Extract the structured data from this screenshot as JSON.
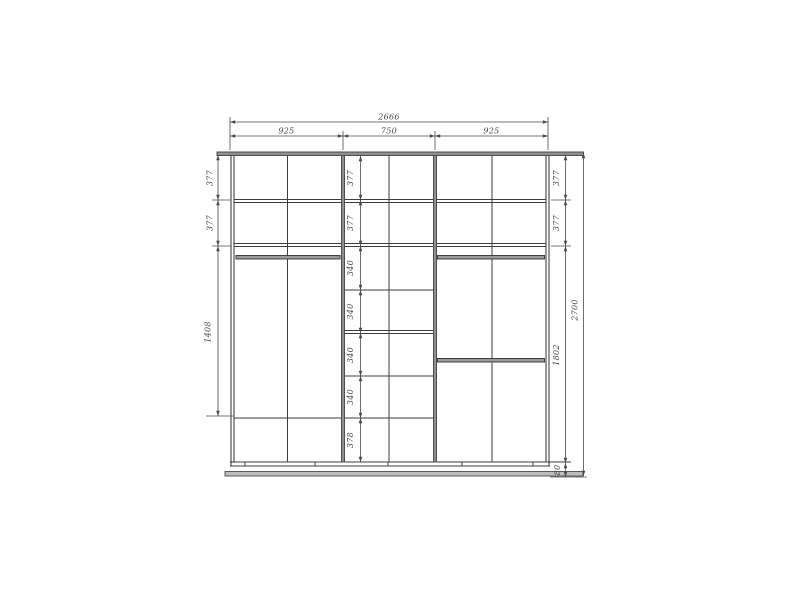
{
  "dims": {
    "total_width": "2666",
    "top_sections": [
      "925",
      "750",
      "925"
    ],
    "left_chain": [
      "377",
      "377",
      "1408"
    ],
    "middle_chain": [
      "377",
      "377",
      "340",
      "340",
      "340",
      "340",
      "378"
    ],
    "right_chain": [
      "377",
      "377",
      "1802",
      "80"
    ],
    "total_height": "2700"
  },
  "colors": {
    "background": "#ffffff",
    "structure_line": "#3d3d3d",
    "panel_gray": "#8f8f8f",
    "plinth_gray": "#bdbdbd",
    "dimension_line": "#4a4a4a",
    "dimension_text": "#474747"
  }
}
